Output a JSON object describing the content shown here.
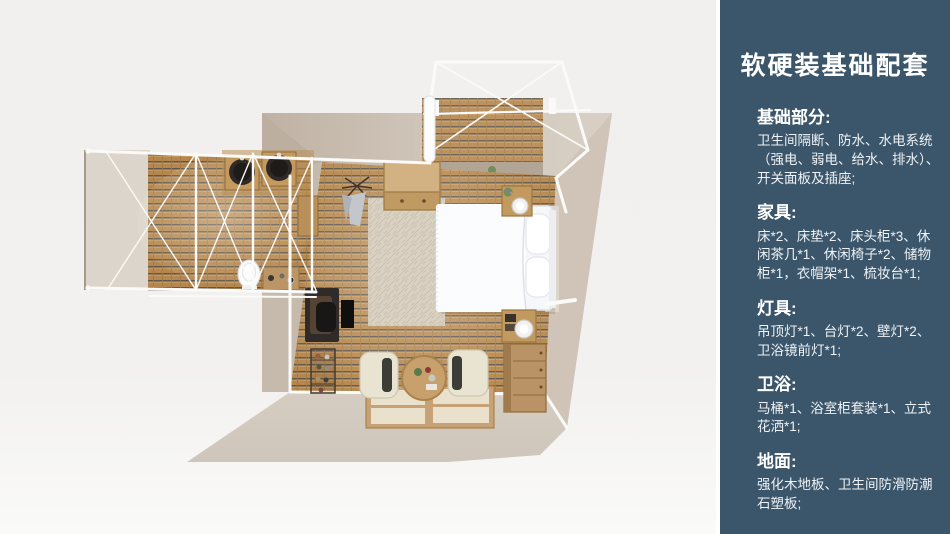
{
  "colors": {
    "background": "#f1f0ee",
    "panel_bg": "#3b566a",
    "panel_text": "#ffffff",
    "wall_beige": "#cdc2b5",
    "wall_light": "#dcd5cb",
    "wood_floor": "#b5874e",
    "wood_gap": "#5f574d",
    "frame_white": "#fafafa",
    "furniture_wood": "#c2995e",
    "bed_white": "#f7f8fa"
  },
  "sidebar": {
    "title": "软硬装基础配套",
    "sections": [
      {
        "heading": "基础部分:",
        "body": "卫生间隔断、防水、水电系统（强电、弱电、给水、排水）、开关面板及插座;"
      },
      {
        "heading": "家具:",
        "body": "床*2、床垫*2、床头柜*3、休闲茶几*1、休闲椅子*2、储物柜*1，衣帽架*1、梳妆台*1;"
      },
      {
        "heading": "灯具:",
        "body": "吊顶灯*1、台灯*2、壁灯*2、卫浴镜前灯*1;"
      },
      {
        "heading": "卫浴:",
        "body": "马桶*1、浴室柜套装*1、立式花洒*1;"
      },
      {
        "heading": "地面:",
        "body": "强化木地板、卫生间防滑防潮石塑板;"
      }
    ]
  },
  "floorplan": {
    "view": "top-down 3D render",
    "areas": [
      "bedroom",
      "bathroom-wing",
      "balcony"
    ],
    "items": [
      "double-bed",
      "pillows",
      "area-rug",
      "storage-cabinet",
      "coat-rack",
      "nightstand-lamp",
      "nightstand-lamp",
      "vanity-desk",
      "shoe-rack",
      "lounge-chair",
      "lounge-chair",
      "round-tea-table",
      "floor-mattresses",
      "dresser",
      "twin-sinks",
      "toilet",
      "white-steel-frame"
    ]
  }
}
